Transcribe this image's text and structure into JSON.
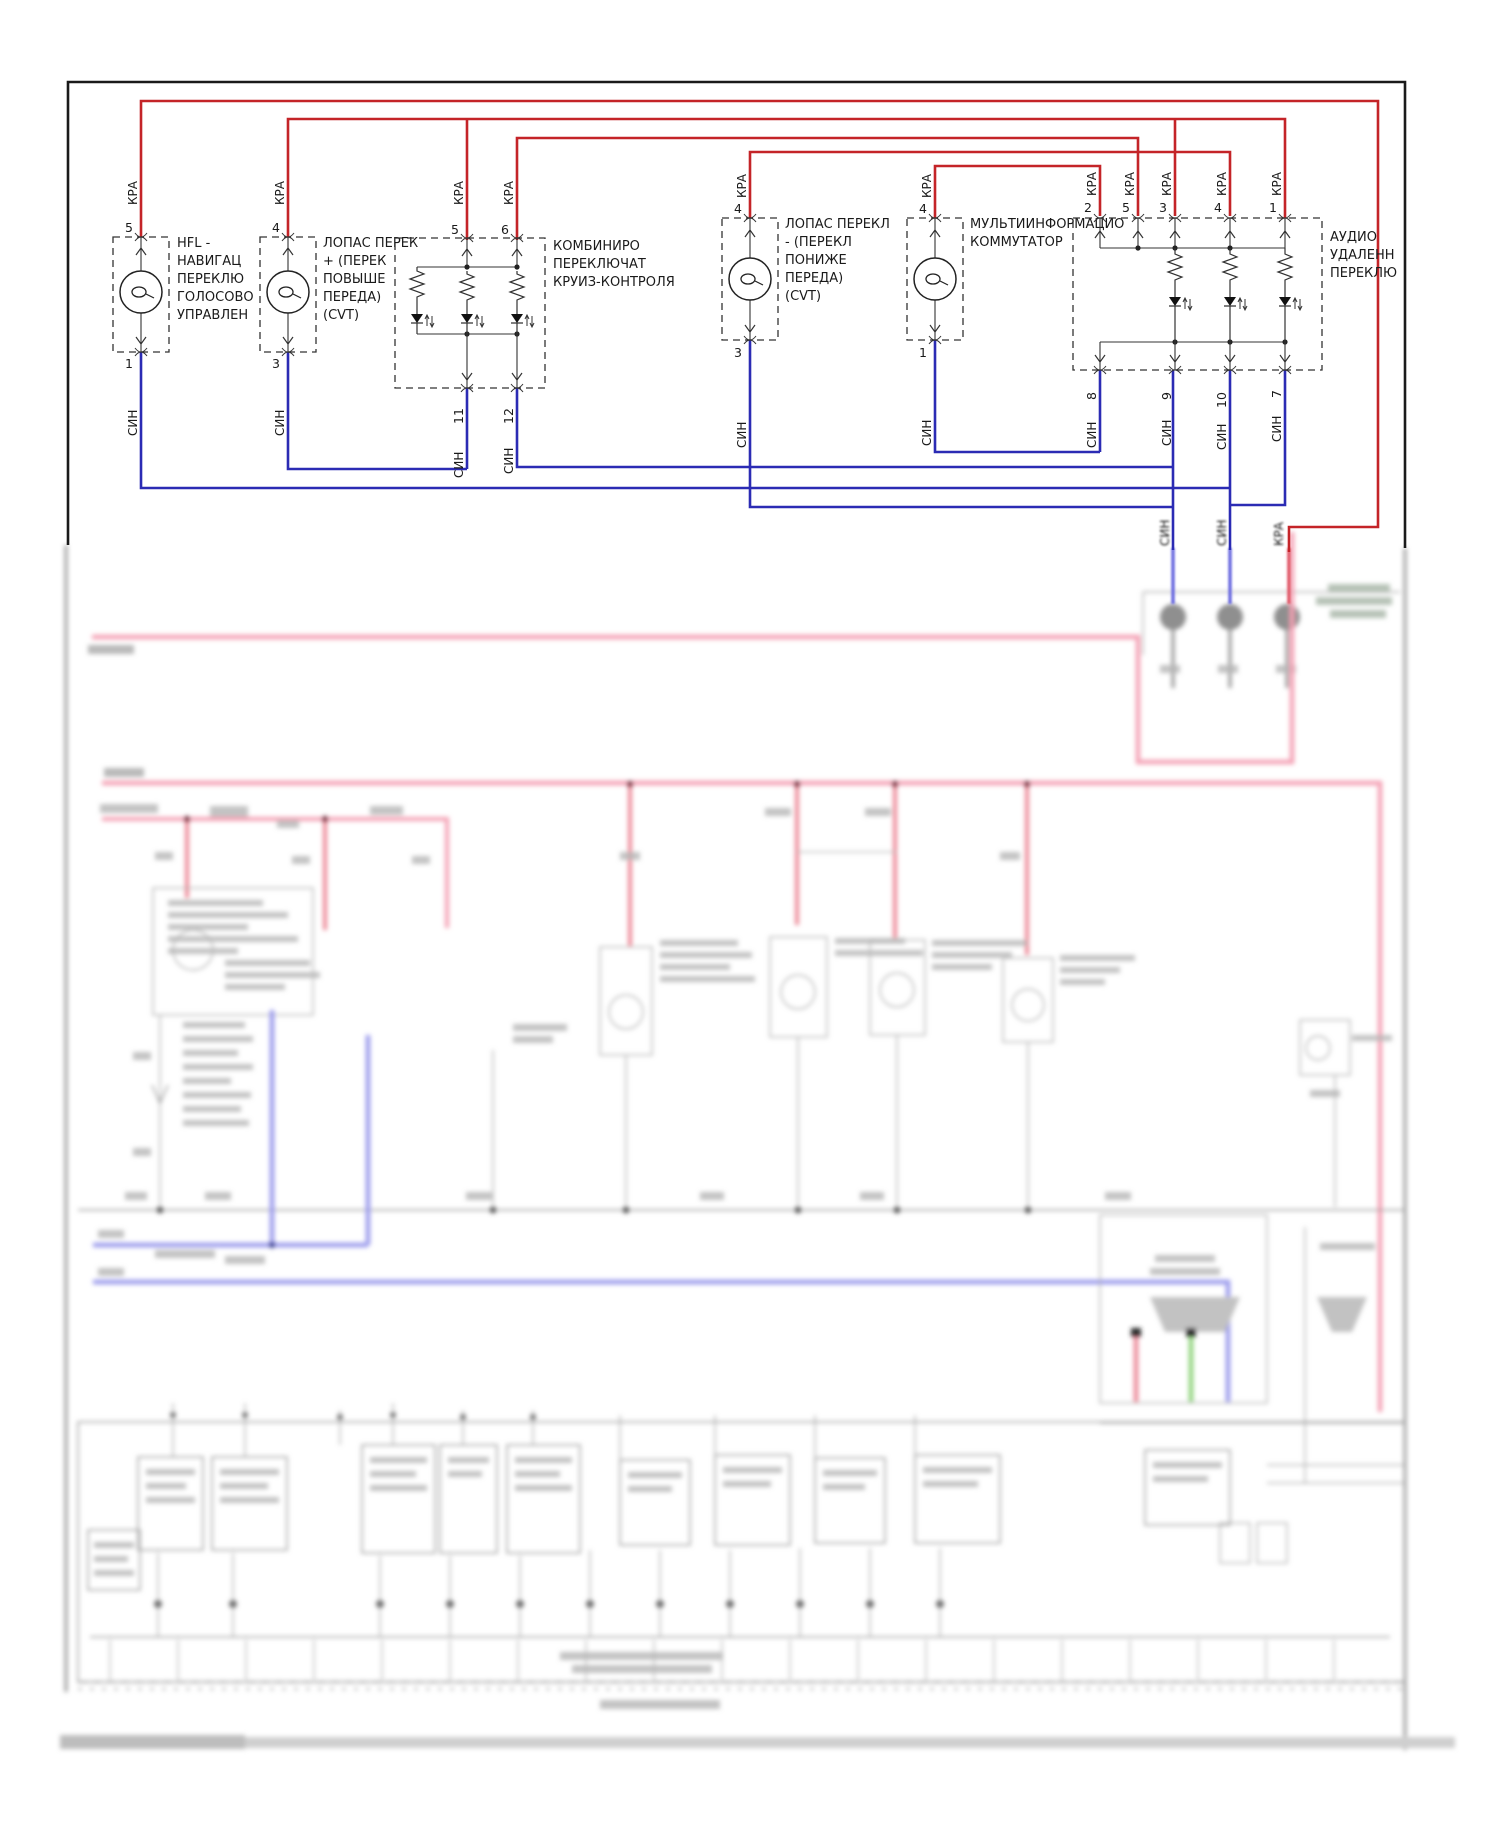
{
  "page": {
    "background": "#ffffff",
    "border_color": "#1a1a1a"
  },
  "wire_labels": {
    "red": "КРА",
    "blue": "СИН"
  },
  "colors": {
    "wire_red": "#c42428",
    "wire_blue": "#2b2bb4",
    "blur_pink": "#f4a0b4",
    "blur_red": "#e87c8c",
    "blur_blue": "#9a9aec",
    "blur_green": "#8ed27a",
    "ghost_grey": "#a8a8a8"
  },
  "components": [
    {
      "id": "hfl-voice-switch",
      "name_lines": [
        "HFL -",
        "НАВИГАЦ",
        "ПЕРЕКЛЮ",
        "ГОЛОСОВО",
        "УПРАВЛЕН"
      ],
      "pin_top": "5",
      "pin_bottom": "1"
    },
    {
      "id": "paddle-shift-up",
      "name_lines": [
        "ЛОПАС ПЕРЕК",
        "+ (ПЕРЕК",
        "ПОВЫШЕ",
        "ПЕРЕДА)",
        "(CVT)"
      ],
      "pin_top": "4",
      "pin_bottom": "3"
    },
    {
      "id": "cruise-control-combo-switch",
      "name_lines": [
        "КОМБИНИРО",
        "ПЕРЕКЛЮЧАТ",
        "КРУИЗ-КОНТРОЛЯ"
      ],
      "pins_top": [
        "5",
        "6"
      ],
      "pins_bottom": [
        "11",
        "12"
      ]
    },
    {
      "id": "paddle-shift-down",
      "name_lines": [
        "ЛОПАС ПЕРЕКЛ",
        "- (ПЕРЕКЛ",
        "ПОНИЖЕ",
        "ПЕРЕДА)",
        "(CVT)"
      ],
      "pin_top": "4",
      "pin_bottom": "3"
    },
    {
      "id": "multi-information-switch",
      "name_lines": [
        "МУЛЬТИИНФОРМАЦИО",
        "КОММУТАТОР"
      ],
      "pin_top": "4",
      "pin_bottom": "1"
    },
    {
      "id": "audio-remote-switch",
      "name_lines": [
        "АУДИО",
        "УДАЛЕНН",
        "ПЕРЕКЛЮ"
      ],
      "pins_top": [
        "2",
        "5",
        "3",
        "4",
        "1"
      ],
      "pins_bottom": [
        "8",
        "9",
        "10",
        "7"
      ]
    }
  ],
  "boundary": {
    "labels": [
      "СИН",
      "СИН",
      "КРА"
    ]
  }
}
